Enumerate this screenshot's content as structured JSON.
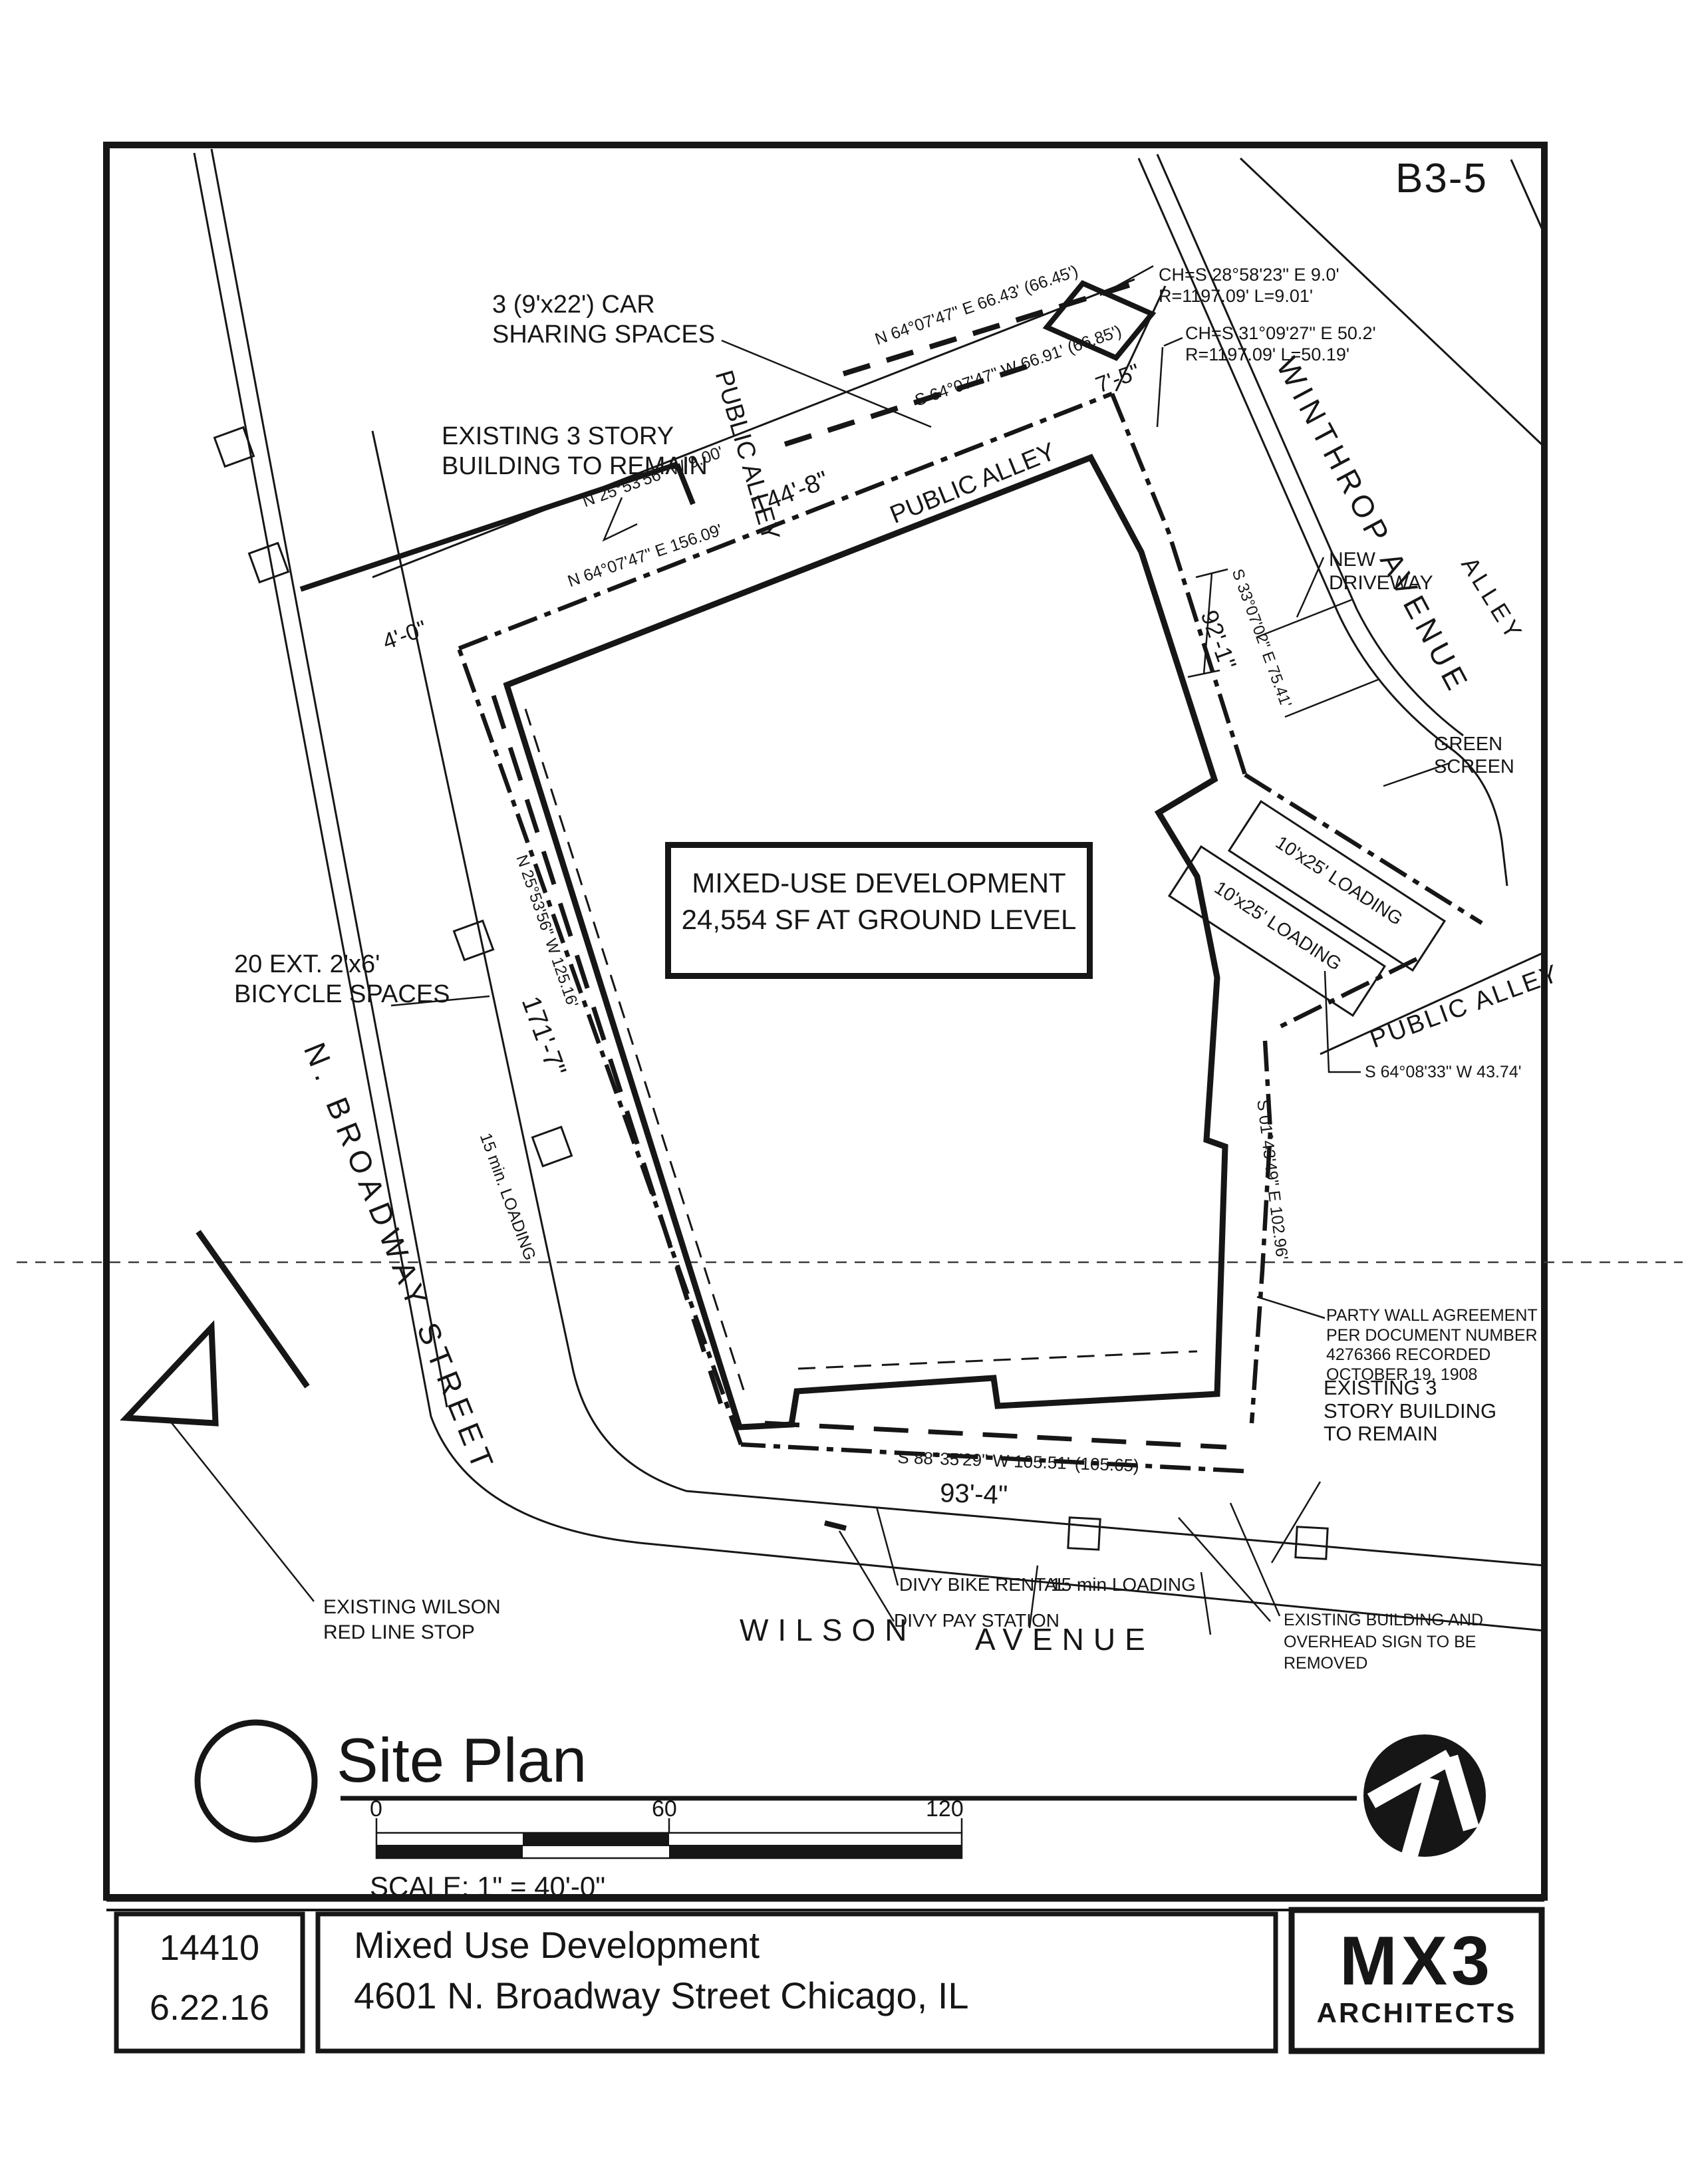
{
  "sheet": {
    "number": "B3-5"
  },
  "plan": {
    "notes": {
      "car_sharing_1": "3 (9'x22') CAR",
      "car_sharing_2": "SHARING SPACES",
      "existing_tl_1": "EXISTING 3 STORY",
      "existing_tl_2": "BUILDING TO REMAIN",
      "new_driveway_1": "NEW",
      "new_driveway_2": "DRIVEWAY",
      "green_screen_1": "GREEN",
      "green_screen_2": "SCREEN",
      "mixed_use_1": "MIXED-USE DEVELOPMENT",
      "mixed_use_2": "24,554 SF AT GROUND LEVEL",
      "loading_stall": "10'x25' LOADING",
      "bicycle_1": "20 EXT. 2'x6'",
      "bicycle_2": "BICYCLE SPACES",
      "loading_15_left": "15 min. LOADING",
      "party_wall_1": "PARTY WALL AGREEMENT",
      "party_wall_2": "PER DOCUMENT NUMBER",
      "party_wall_3": "4276366 RECORDED",
      "party_wall_4": "OCTOBER 19, 1908",
      "existing_r_1": "EXISTING 3",
      "existing_r_2": "STORY BUILDING",
      "existing_r_3": "TO REMAIN",
      "divy_bike": "DIVY BIKE RENTAL",
      "divy_pay": "DIVY PAY STATION",
      "loading_15_bottom": "15 min LOADING",
      "removed_1": "EXISTING BUILDING AND",
      "removed_2": "OVERHEAD SIGN TO BE",
      "removed_3": "REMOVED",
      "red_line_1": "EXISTING WILSON",
      "red_line_2": "RED LINE STOP"
    },
    "streets": {
      "broadway": "N. BROADWAY  STREET",
      "wilson_1": "WILSON",
      "wilson_2": "AVENUE",
      "winthrop": "WINTHROP AVENUE",
      "alley": "ALLEY",
      "public_alley_vert": "PUBLIC ALLEY",
      "public_alley_top": "PUBLIC ALLEY",
      "public_alley_right": "PUBLIC ALLEY"
    },
    "bearings": {
      "top_n": "N 64°07'47\" E 66.43' (66.45')",
      "top_s": "S 64°07'47\" W 66.91' (66.85')",
      "w9": "N 25°53'56\" W 9.00'",
      "e156": "N 64°07'47\" E  156.09'",
      "s33": "S 33°07'02\" E 75.41'",
      "s64": "S 64°08'33\" W 43.74'",
      "s01": "S 01°43'49\" E 102.96'",
      "s88": "S 88°35'29\" W 105.51' (105.65)",
      "w125": "N 25°53'56\" W 125.16'"
    },
    "dimensions": {
      "d144": "144'-8\"",
      "d7": "7'-5\"",
      "d4": "4'-0\"",
      "d92": "92'-1\"",
      "d171": "171'-7\"",
      "d93": "93'-4\""
    },
    "curves": {
      "c1a": "CH=S 28°58'23\" E  9.0'",
      "c1b": "R=1197.09' L=9.01'",
      "c2a": "CH=S 31°09'27\" E  50.2'",
      "c2b": "R=1197.09' L=50.19'"
    }
  },
  "titleblock": {
    "title": "Site Plan",
    "scale_label": "SCALE: 1\" = 40'-0\"",
    "ticks": [
      "0",
      "60",
      "120"
    ],
    "project_number": "14410",
    "date": "6.22.16",
    "project_name": "Mixed Use Development",
    "project_address": "4601 N. Broadway Street  Chicago, IL",
    "firm": "MX3",
    "firm_sub": "ARCHITECTS"
  }
}
